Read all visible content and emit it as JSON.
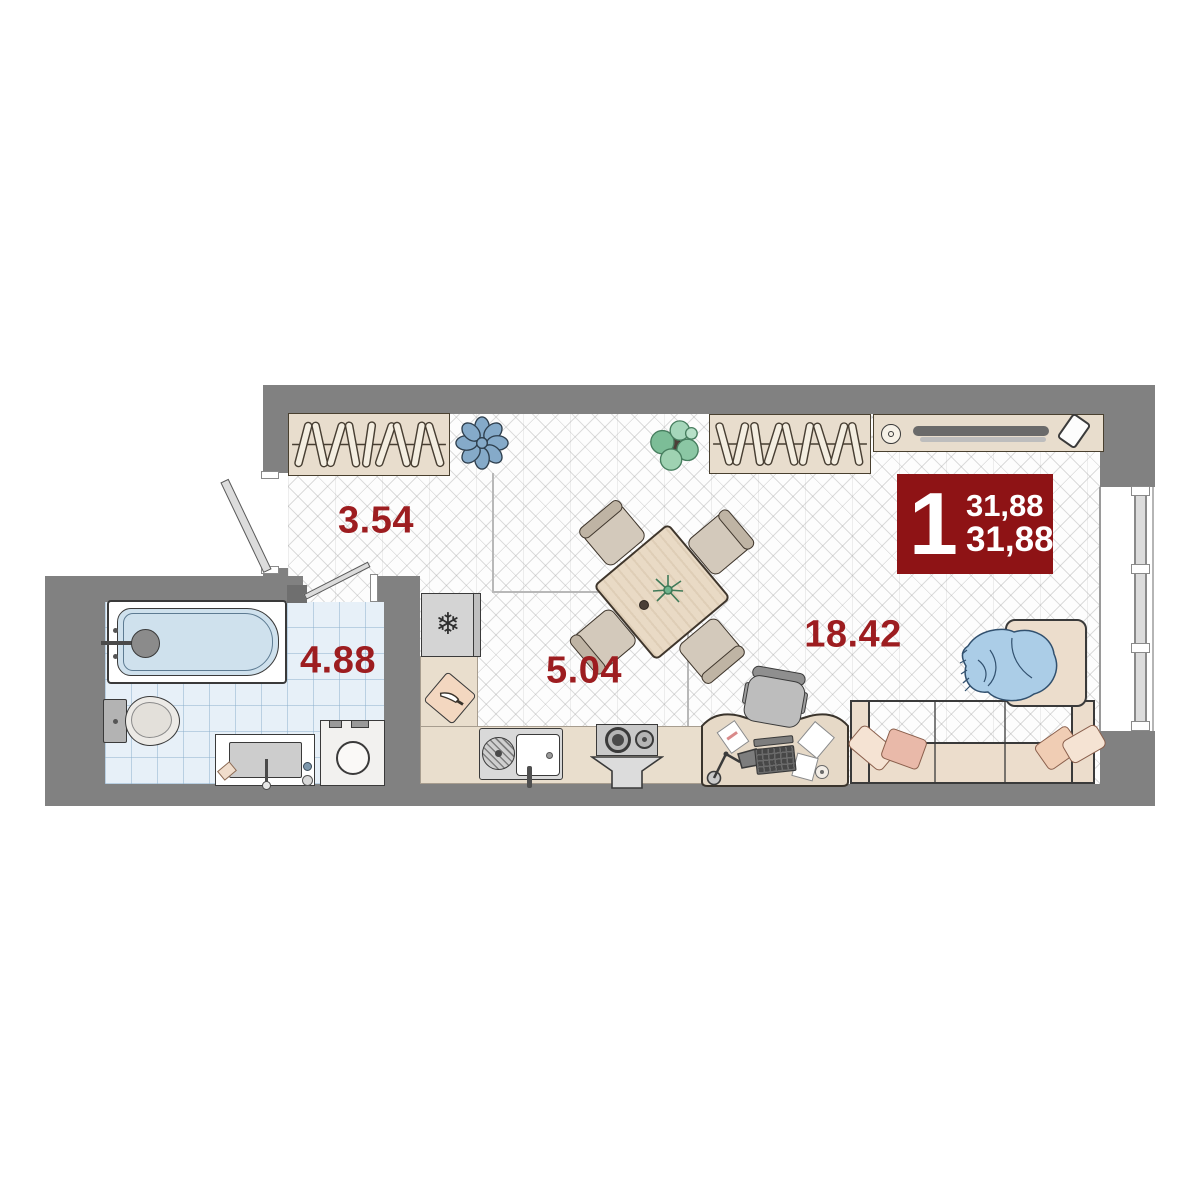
{
  "plan": {
    "badge": {
      "rooms_count": "1",
      "area_top": "31,88",
      "area_bottom": "31,88"
    },
    "rooms": [
      {
        "name": "hallway",
        "area_label": "3.54"
      },
      {
        "name": "bathroom",
        "area_label": "4.88"
      },
      {
        "name": "kitchen",
        "area_label": "5.04"
      },
      {
        "name": "living-room",
        "area_label": "18.42"
      }
    ],
    "icons": {
      "fridge_snowflake": "❄"
    },
    "colors": {
      "wall_gray": "#818181",
      "label_red": "#9d1d20",
      "badge_red": "#8e1315",
      "tile_blue": "#e7f0f8",
      "furniture_beige": "#e8ddcd",
      "pouf_blue": "#85aac9",
      "blanket_blue": "#abcde7"
    }
  }
}
